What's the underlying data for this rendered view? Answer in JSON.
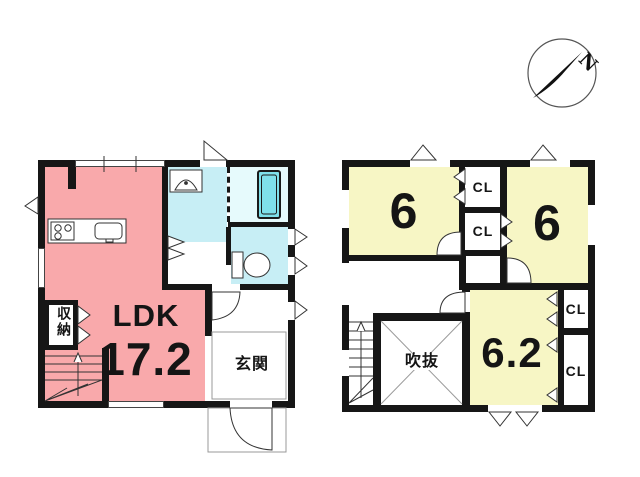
{
  "compass": {
    "north_label": "N"
  },
  "colors": {
    "wall": "#161616",
    "ldk_fill": "#f9a9ab",
    "wet_area_fill": "#c7eef5",
    "bathroom_fill": "#e6fafc",
    "bathtub_fill": "#7fe0ea",
    "bedroom_fill": "#f7f6c5"
  },
  "floor1": {
    "ldk_label": "LDK",
    "ldk_area": "17.2",
    "storage_label": "収納",
    "entrance_label": "玄関"
  },
  "floor2": {
    "bedroom_left_label": "6",
    "bedroom_right_label": "6",
    "bedroom_bottom_label": "6.2",
    "void_label": "吹抜",
    "closet_labels": [
      "CL",
      "CL",
      "CL",
      "CL"
    ]
  }
}
